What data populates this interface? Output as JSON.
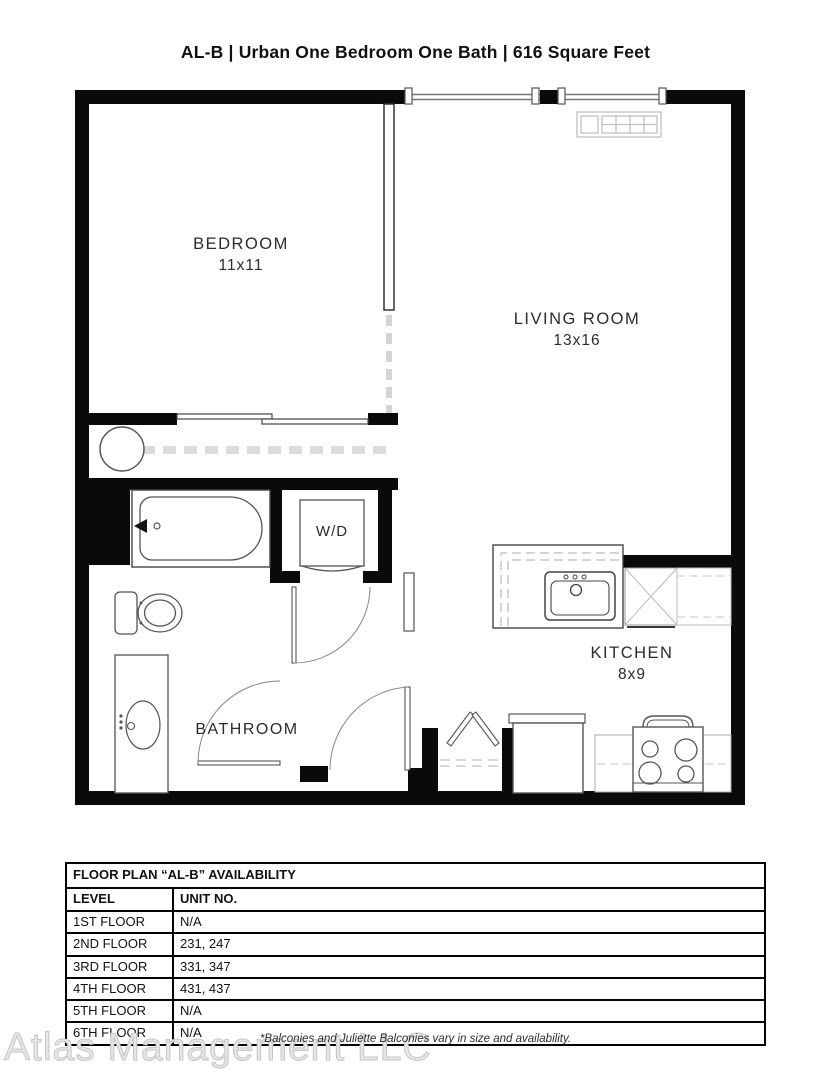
{
  "header": {
    "title": "AL-B | Urban One Bedroom One Bath | 616 Square Feet"
  },
  "floorplan": {
    "rooms": [
      {
        "name": "BEDROOM",
        "dims": "11x11"
      },
      {
        "name": "LIVING ROOM",
        "dims": "13x16"
      },
      {
        "name": "KITCHEN",
        "dims": "8x9"
      },
      {
        "name": "BATHROOM",
        "dims": ""
      },
      {
        "name": "W/D",
        "dims": ""
      }
    ]
  },
  "availability_table": {
    "title": "FLOOR PLAN “AL-B” AVAILABILITY",
    "columns": {
      "level": "LEVEL",
      "unit": "UNIT NO."
    },
    "rows": [
      {
        "level": "1ST FLOOR",
        "units": "N/A"
      },
      {
        "level": "2ND FLOOR",
        "units": "231, 247"
      },
      {
        "level": "3RD FLOOR",
        "units": "331, 347"
      },
      {
        "level": "4TH FLOOR",
        "units": "431, 437"
      },
      {
        "level": "5TH FLOOR",
        "units": "N/A"
      },
      {
        "level": "6TH FLOOR",
        "units": "N/A"
      }
    ]
  },
  "footer": {
    "note": "*Balconies and Juliette Balconies vary in size and availability.",
    "watermark": "Atlas Management LLC"
  },
  "colors": {
    "wall": "#0a0a0a",
    "line": "#444444",
    "light_line": "#c0c0c0"
  }
}
